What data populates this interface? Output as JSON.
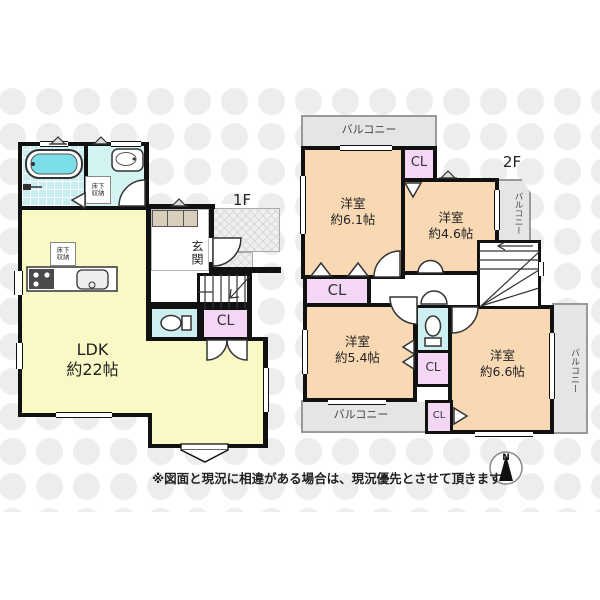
{
  "floor1": {
    "label": "1F",
    "ldk": {
      "name": "LDK",
      "size": "約22帖"
    },
    "entrance_label": "玄関",
    "closet_label": "CL",
    "storage_bath": "床下収納",
    "storage_ldk": "床下収納"
  },
  "floor2": {
    "label": "2F",
    "rooms": {
      "r61": {
        "name": "洋室",
        "size": "約6.1帖"
      },
      "r46": {
        "name": "洋室",
        "size": "約4.6帖"
      },
      "r54": {
        "name": "洋室",
        "size": "約5.4帖"
      },
      "r66": {
        "name": "洋室",
        "size": "約6.6帖"
      }
    },
    "closets": {
      "top": "CL",
      "left": "CL",
      "mid": "CL",
      "bottom": "CL"
    },
    "balconies": {
      "top": "バルコニー",
      "right_top": "バルコニー",
      "bottom": "バルコニー",
      "right_bottom": "バルコニー"
    }
  },
  "compass": {
    "label": "N"
  },
  "disclaimer": "※図面と現況に相違がある場合は、現況優先とさせて頂きます",
  "colors": {
    "wall": "#111111",
    "ldk_fill": "#f9f9c6",
    "room_fill": "#f8d9b4",
    "closet_fill": "#f4d7f4",
    "wet_fill": "#cdeff1",
    "balcony_fill": "#e5e5e5",
    "water": "#7adee8"
  }
}
